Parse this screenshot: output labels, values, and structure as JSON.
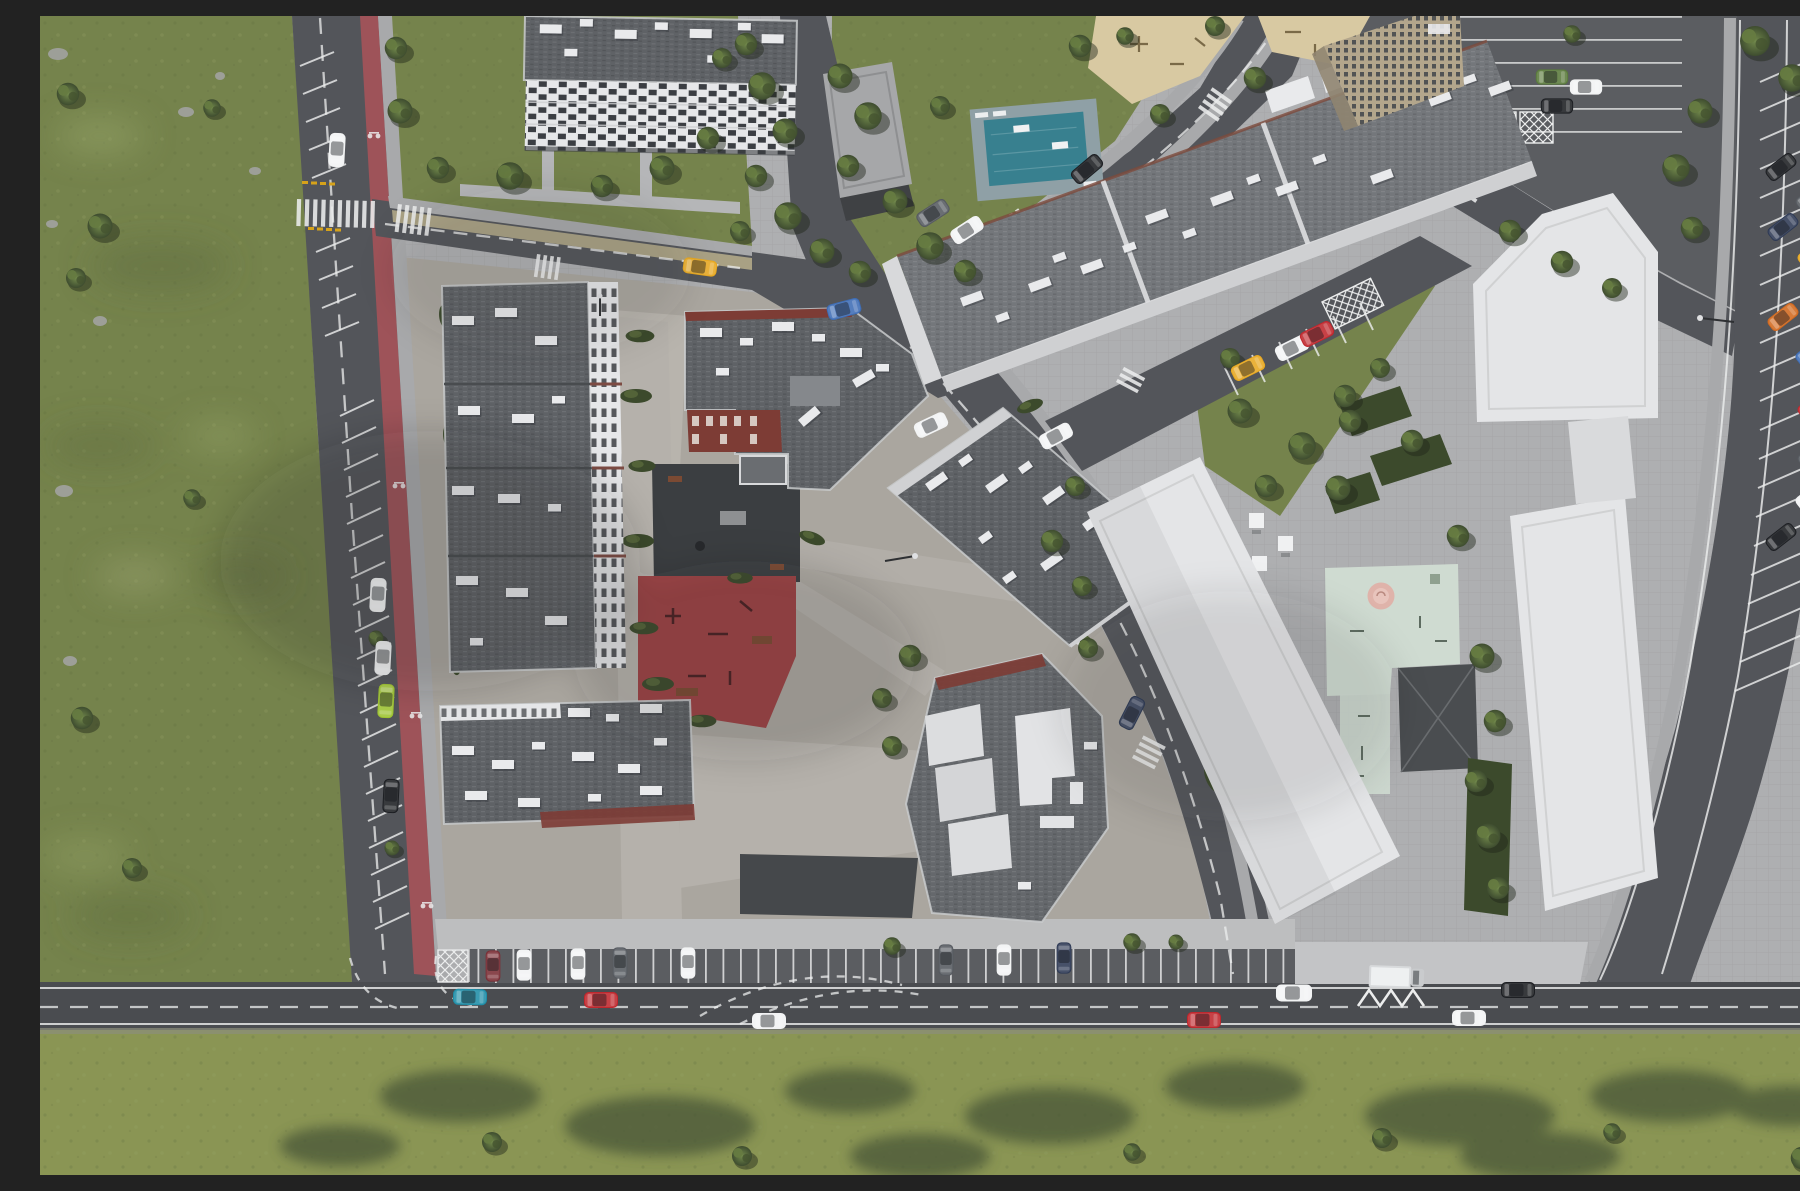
{
  "meta": {
    "type": "aerial-architectural-render",
    "description": "Top-down aerial 3D rendering of a residential masterplan: left and bottom grass meadows, a north-south avenue with red bike lane and street parking, a south boulevard with a parking lay-by, a central housing block with gray shingle roofs, white rooftop units, a shaded courtyard, a red playground, white office slabs and a pentagon-shaped white building around a mint-green kids area, a northeast mixed-use slab with sand playground, pool deck, and streets with many parked cars including yellow taxis"
  },
  "palette": {
    "meadow": "#75834c",
    "meadow-bottom": "#8a9554",
    "meadow-dark": "#5f6c3f",
    "meadow-light": "#9aa86b",
    "tree-dark": "#3c4a2c",
    "tree-mid": "#55683e",
    "tree-light": "#71884b",
    "road": "#53555a",
    "road-dark": "#4a4c50",
    "asphalt": "#5b5d61",
    "bike-lane": "#9e5359",
    "sidewalk": "#a8a9ab",
    "plaza": "#aeafb1",
    "plaza-white": "#bdbebf",
    "paver-warm": "#aaa69f",
    "paver-light": "#b8b4ad",
    "courtyard-dark": "#3b3e41",
    "roof": "#5f6266",
    "roof-light": "#74777b",
    "roof-hex": "#65686c",
    "roof-parapet": "#c9cbcd",
    "roof-white-box": "#e9eaec",
    "facade-white": "#e6e7e9",
    "window-dark": "#383b3f",
    "brick-red": "#7d3c35",
    "sand": "#d8c9a2",
    "pool-teal": "#38808f",
    "pool-deck": "#8fa0a6",
    "mint": "#cfdbd1",
    "pink": "#dfb3aa",
    "white-building": "#e4e5e7",
    "beige-tower": "#b3a68c",
    "marking-white": "#eceded",
    "taxi-yellow": "#e8a820",
    "car-red": "#c0272d",
    "car-maroon": "#7a2e35",
    "car-teal": "#1f8ea8",
    "car-blue": "#3e6db5",
    "car-navy": "#2e3a55",
    "car-lime": "#9fc531",
    "car-orange": "#d2691e",
    "car-green": "#5a7a3c",
    "car-white": "#f2f3f4",
    "car-black": "#1d1f23",
    "car-gray": "#565a60",
    "shadow": "#24262a"
  },
  "scene": {
    "ground": [
      "left meadow with rocks and scattered trees",
      "bottom meadow strip with tree shadows",
      "central courtyard paving",
      "white plaza by office slabs"
    ],
    "roads": [
      "north-south avenue with red bike lane, street parking bays and zebra crossing",
      "north access road with tan bike path",
      "northeast diagonal road with zebra crossings",
      "southeast curving road past the hexagonal block",
      "south boulevard with parking lay-by and zigzag marking",
      "far-right street with angled parking bays"
    ],
    "buildings": [
      {
        "id": "nw-apartment-block",
        "look": "gray roof, white checkered window facade"
      },
      {
        "id": "utility-pavilion",
        "look": "small flat gray roof with ramp"
      },
      {
        "id": "west-residential-slab",
        "look": "long gray roof, white east facade with windows"
      },
      {
        "id": "southwest-residential-slab",
        "look": "gray roof, brick-red south edge"
      },
      {
        "id": "center-l-block",
        "look": "L-shaped, gray roof, brick-red facade accents"
      },
      {
        "id": "east-residential-slab",
        "look": "rotated slab with white parapet"
      },
      {
        "id": "hexagonal-block",
        "look": "gray shingle roof, white stepped terraces, brick edge"
      },
      {
        "id": "northeast-long-slab",
        "look": "diagonal slab, light gray roof, white rooftop units, arcade"
      },
      {
        "id": "beige-tower",
        "look": "high-rise with dark window grid"
      },
      {
        "id": "white-office-slab-a",
        "look": "large white flat roof"
      },
      {
        "id": "white-office-slab-b",
        "look": "large white flat roof"
      },
      {
        "id": "white-pentagon-building",
        "look": "pentagon footprint white roof"
      }
    ],
    "amenities": [
      "teal pool with white loungers",
      "sand playground with equipment",
      "shaded dark courtyard playground",
      "red playground with equipment and benches",
      "mint-green kids area with pink carousel",
      "dark garden pavilion",
      "white picnic tables",
      "hedge planters"
    ],
    "vehicles": {
      "total": 45,
      "notable": [
        "yellow taxi on north access road",
        "yellow taxi parked on northeast service road",
        "yellow taxi in far-right angled parking",
        "white box truck at south lay-by",
        "teal car and red car on south boulevard",
        "lime hatchback parked on the avenue"
      ]
    },
    "markings": [
      "zebra crosswalks",
      "dashed centerlines",
      "diagonal parking bay lines",
      "cross-hatched keep-clear boxes",
      "zigzag no-stopping line",
      "yellow give-way dashes"
    ]
  }
}
